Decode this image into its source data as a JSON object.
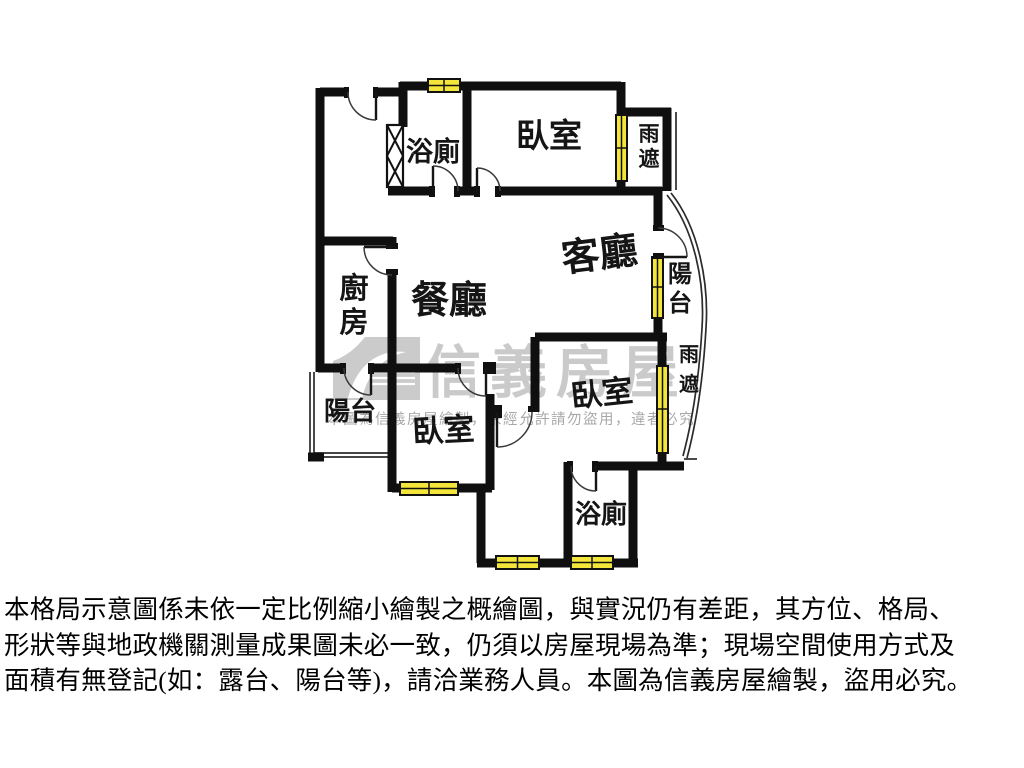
{
  "floorplan": {
    "colors": {
      "wall": "#0f0f0f",
      "window_fill": "#f3e53a",
      "watermark": "#9a9a9a"
    },
    "rooms": {
      "bath_top": {
        "label": "浴廁"
      },
      "bedroom_top": {
        "label": "臥室"
      },
      "canopy_top": {
        "c1": "雨",
        "c2": "遮"
      },
      "living": {
        "label": "客廳"
      },
      "balcony_right": {
        "c1": "陽",
        "c2": "台"
      },
      "dining": {
        "label": "餐廳"
      },
      "kitchen": {
        "c1": "廚",
        "c2": "房"
      },
      "balcony_left": {
        "label": "陽台"
      },
      "bedroom_left": {
        "label": "臥室"
      },
      "bedroom_right": {
        "label": "臥室"
      },
      "canopy_bottom": {
        "c1": "雨",
        "c2": "遮"
      },
      "bath_bottom": {
        "label": "浴廁"
      }
    }
  },
  "watermark": {
    "brand": "信義房屋",
    "notice": "本圖為信義房屋繪製，未經允許請勿盜用，違者必究"
  },
  "disclaimer": {
    "line1": "本格局示意圖係未依一定比例縮小繪製之概繪圖，與實況仍有差距，其方位、格局、",
    "line2": "形狀等與地政機關測量成果圖未必一致，仍須以房屋現場為準；現場空間使用方式及",
    "line3": "面積有無登記(如：露台、陽台等)，請洽業務人員。本圖為信義房屋繪製，盜用必究。"
  }
}
